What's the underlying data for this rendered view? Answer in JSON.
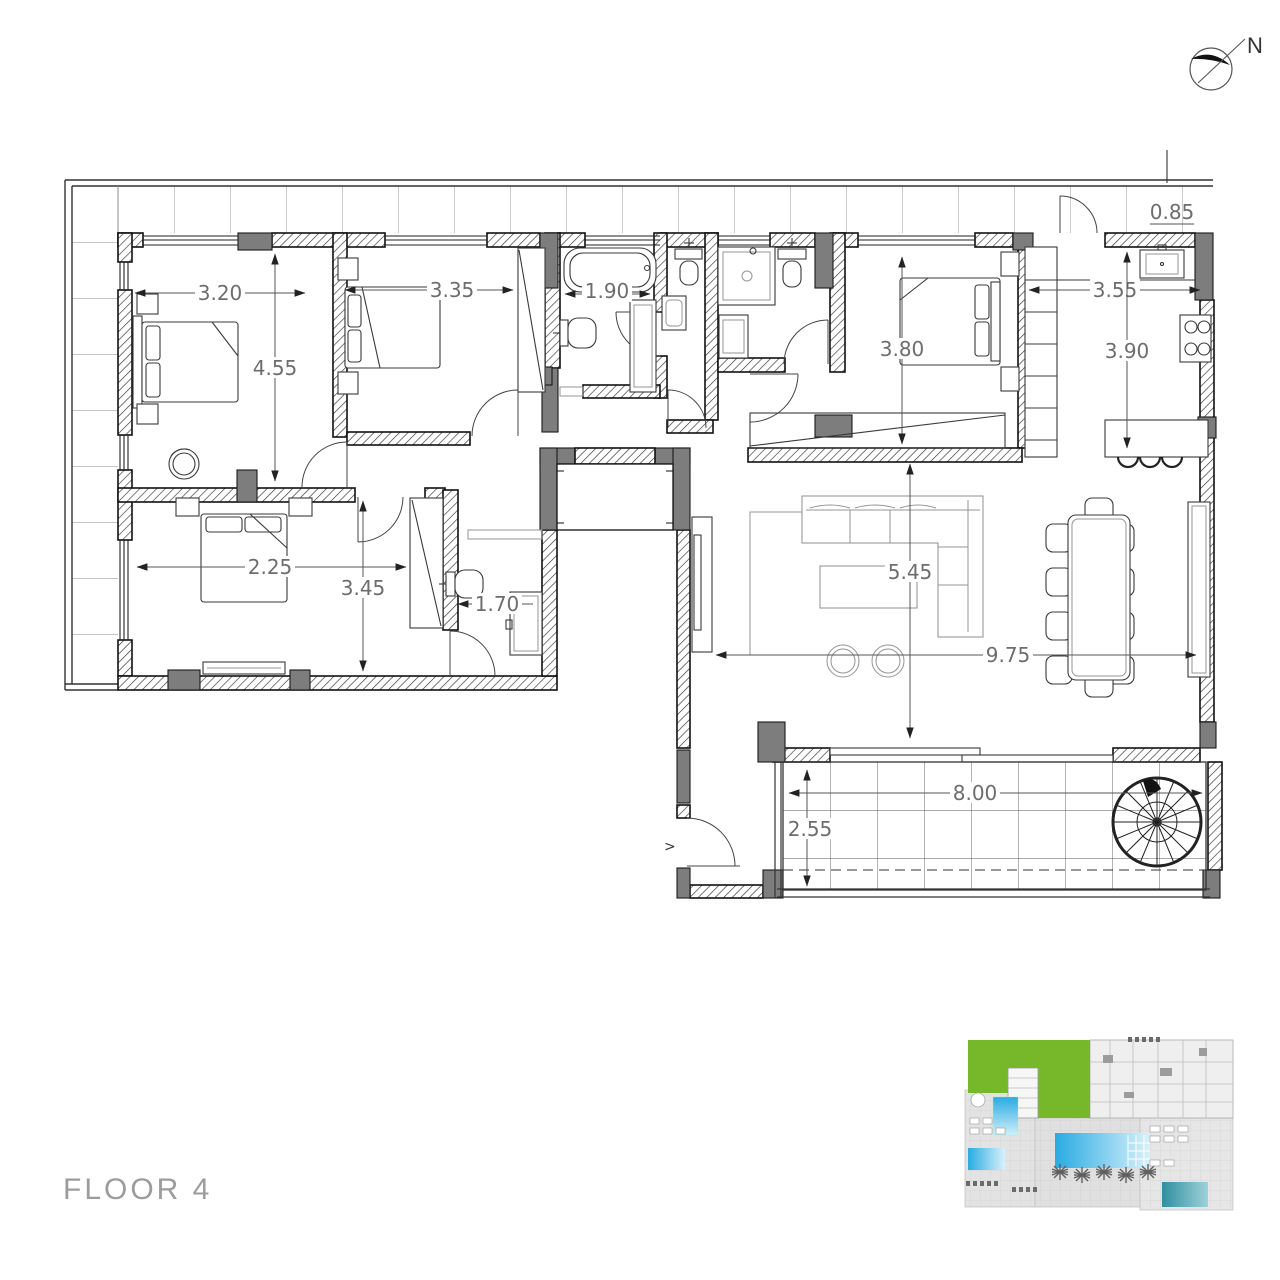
{
  "title": {
    "floor_label": "FLOOR 4"
  },
  "compass": {
    "north_label": "N"
  },
  "markers": {
    "section_marker": ">"
  },
  "colors": {
    "wall_dark_gray": "#7d7d7d",
    "highlight_green": "#76b82a",
    "pool_blue": "#29abe2",
    "pool_teal": "#2e8fa0",
    "dimension_text": "#6d6d6d",
    "title_text": "#9c9c9c"
  },
  "dimensions": {
    "bedroom1_width": "3.20",
    "bedroom1_depth": "4.55",
    "bedroom2_width": "3.35",
    "bathroom1_width": "1.90",
    "bedroom3_depth": "3.80",
    "kitchen_width": "3.55",
    "kitchen_depth": "3.90",
    "entrance_width": "0.85",
    "bedroom4_width": "2.25",
    "bedroom4_depth": "3.45",
    "bathroom3_width": "1.70",
    "living_depth": "5.45",
    "living_width": "9.75",
    "terrace_width": "8.00",
    "terrace_depth": "2.55"
  }
}
